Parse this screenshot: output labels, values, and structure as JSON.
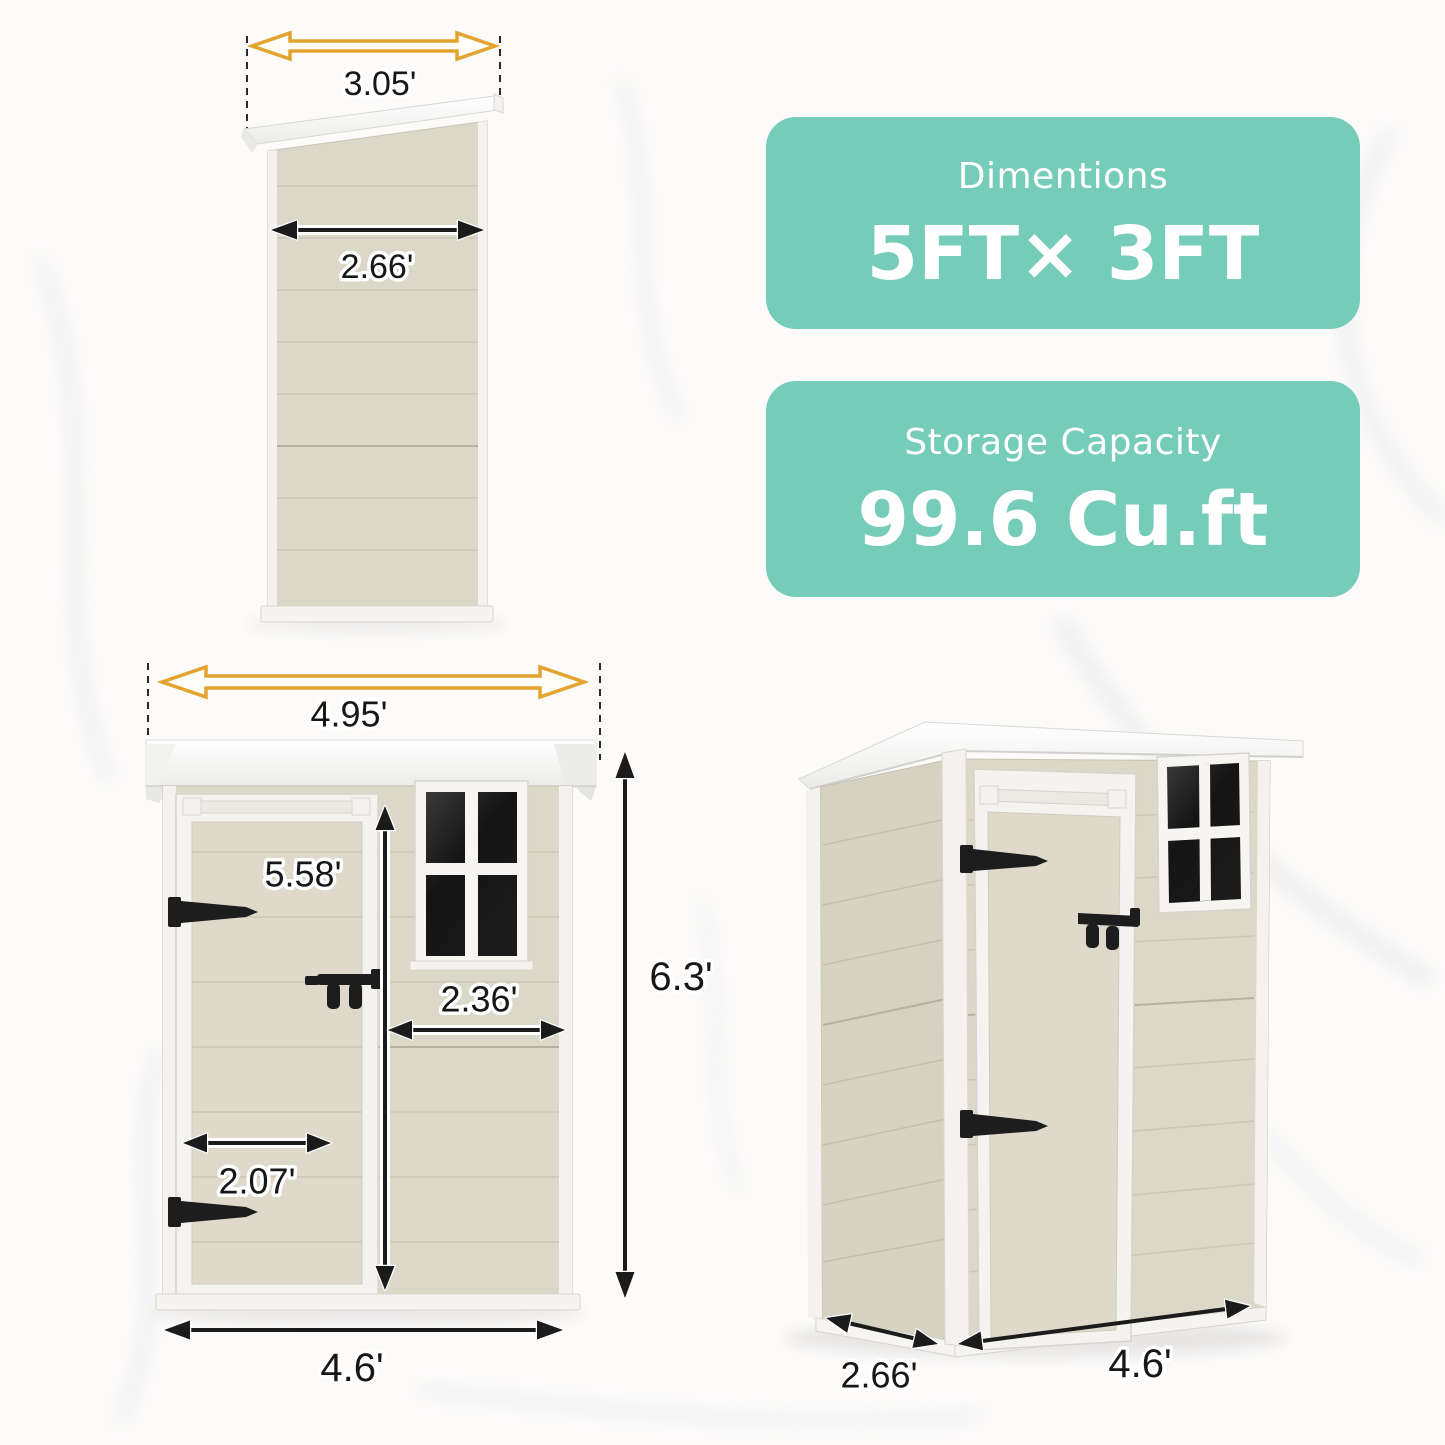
{
  "badges": {
    "dimensions": {
      "title": "Dimentions",
      "value": "5FT× 3FT"
    },
    "storage": {
      "title": "Storage Capacity",
      "value": "99.6 Cu.ft"
    }
  },
  "views": {
    "side": {
      "roof_width": "3.05'",
      "wall_width": "2.66'"
    },
    "front": {
      "roof_width": "4.95'",
      "door_height": "5.58'",
      "window_width": "2.36'",
      "door_width": "2.07'",
      "overall_height": "6.3'",
      "overall_width": "4.6'"
    },
    "perspective": {
      "depth": "2.66'",
      "width": "4.6'"
    }
  },
  "colors": {
    "badge_teal": "#74ccb9",
    "arrow_yellow": "#e2a42f",
    "wall_beige": "#dcd8c9",
    "trim_white": "#f4f3ef",
    "window_glass": "#161616",
    "dimension_text": "#171717"
  }
}
